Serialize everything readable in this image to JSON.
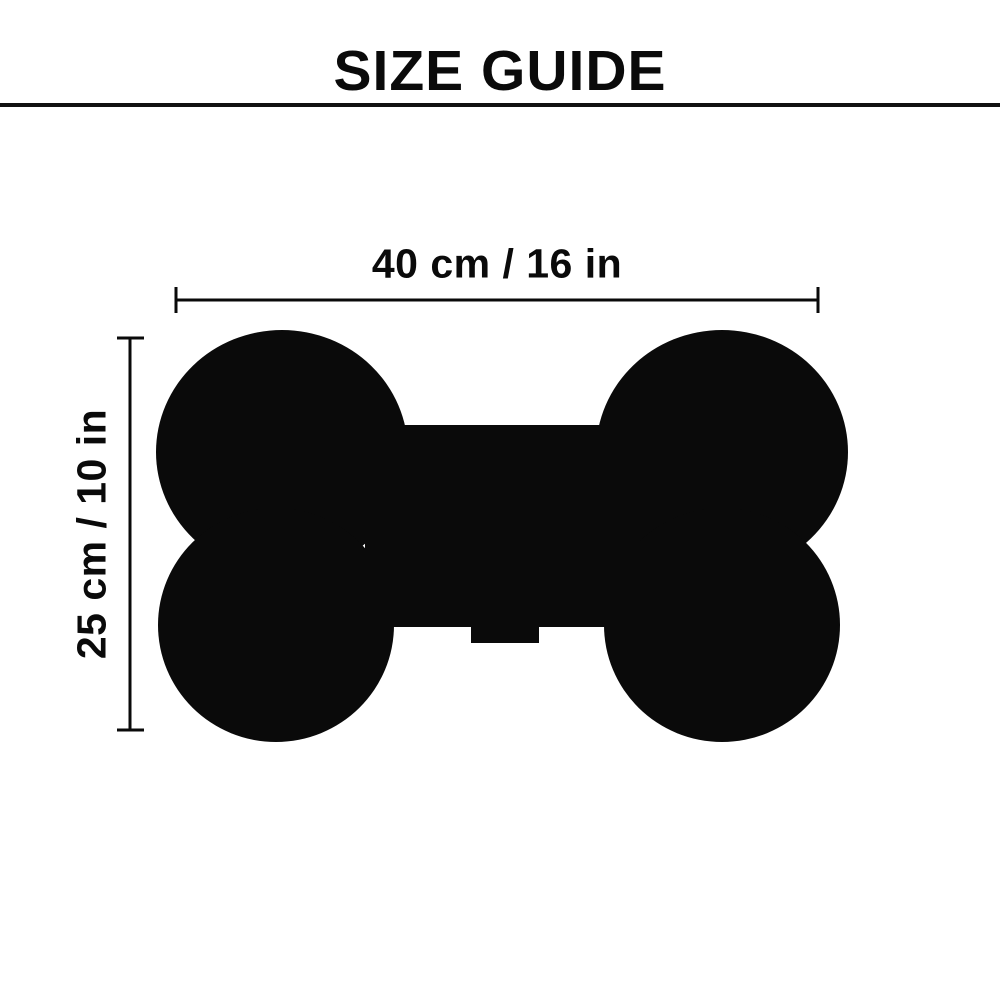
{
  "title": "SIZE GUIDE",
  "figure": {
    "name": "dog-bone-silhouette",
    "description": "black bone-shaped pet mat silhouette with small tag at bottom center"
  },
  "dimensions": {
    "width": {
      "label": "40 cm / 16 in",
      "cm": 40,
      "in": 16
    },
    "height": {
      "label": "25 cm / 10 in",
      "cm": 25,
      "in": 10
    }
  },
  "colors": {
    "background": "#ffffff",
    "ink": "#0a0a0a",
    "divider": "#111111"
  }
}
